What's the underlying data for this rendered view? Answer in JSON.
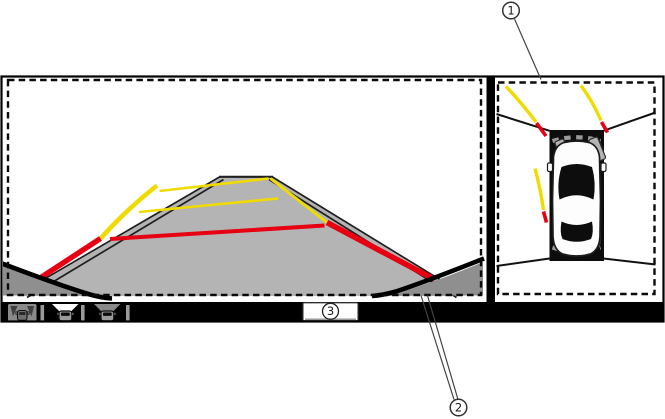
{
  "screen": {
    "rear_view": {
      "name": "rear-wide-camera-view"
    },
    "around_view": {
      "name": "around-view-monitor"
    },
    "bottom_bar": {
      "mode_icons": [
        {
          "name": "rear-wide-view-mode-icon",
          "state": "selected"
        },
        {
          "name": "rear-view-mode-icon",
          "state": "active"
        },
        {
          "name": "rear-zoom-view-mode-icon",
          "state": "inactive"
        }
      ]
    }
  },
  "callouts": {
    "around_view": {
      "label": "1"
    },
    "rear_bumper": {
      "label": "2"
    },
    "view_switch_button": {
      "label": "3"
    }
  },
  "colors": {
    "guide_yellow": "#f0db00",
    "guide_red": "#e60012",
    "road_gray": "#b4b4b4",
    "bumper_gray": "#8f8f8f",
    "bar_black": "#000000",
    "icon_gray": "#8a8a8a"
  }
}
